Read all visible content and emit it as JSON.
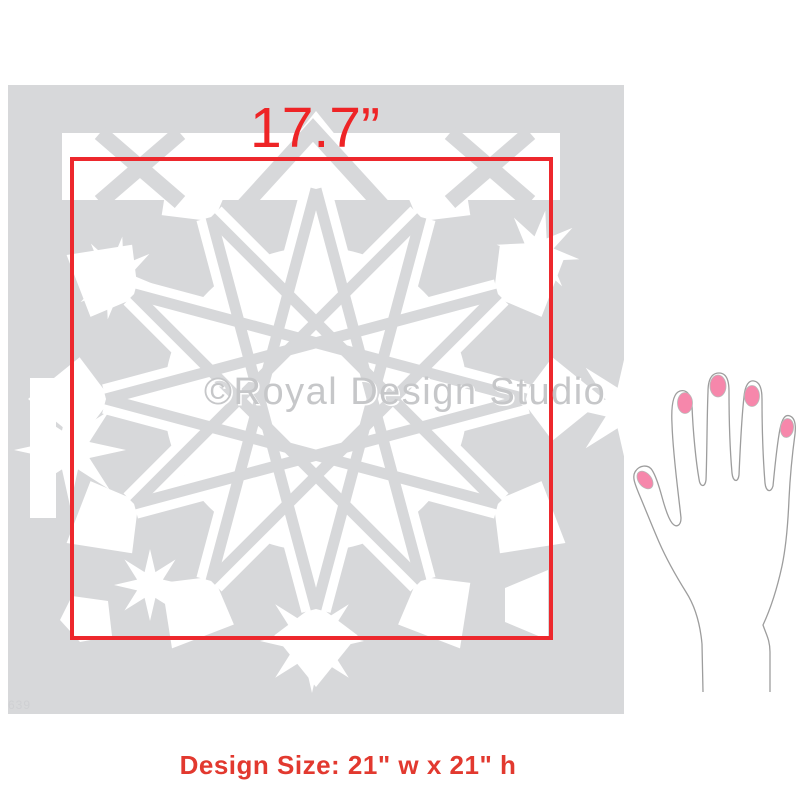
{
  "measurement": {
    "width_label": "17.7”",
    "label_color": "#ee2426",
    "box_color": "#ed282d"
  },
  "stencil": {
    "watermark": "©Royal Design Studio",
    "sku": "639",
    "sheet_color": "#d7d8da",
    "cutout_color": "#ffffff",
    "pattern": "moroccan-star-tile"
  },
  "footer": {
    "design_size_label": "Design Size: 21\" w x 21\" h",
    "label_color": "#e2392f"
  },
  "hand_illustration": {
    "nail_color": "#f687ab",
    "outline_color": "#9d9d9d"
  }
}
